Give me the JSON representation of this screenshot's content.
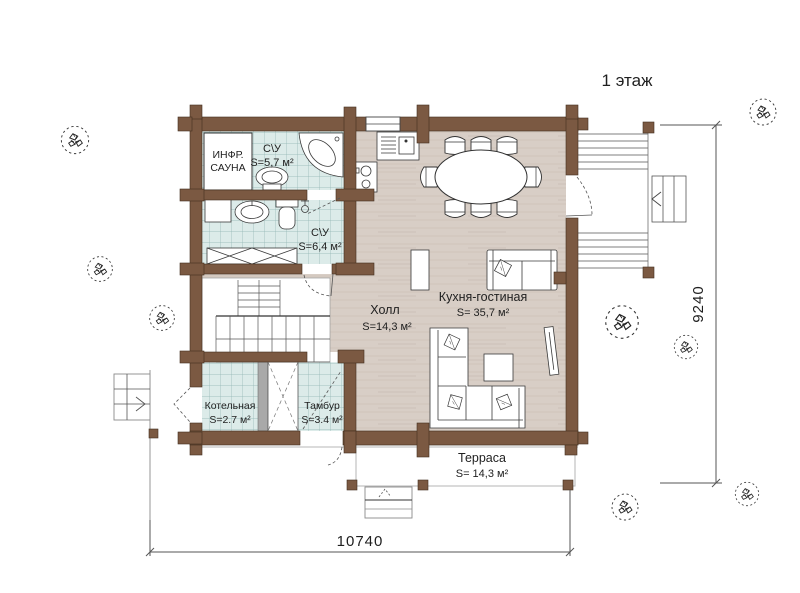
{
  "title": "1 этаж",
  "rooms": {
    "sauna": {
      "line1": "ИНФР.",
      "line2": "САУНА"
    },
    "wc1": {
      "label": "С\\У",
      "area": "S=5,7 м²"
    },
    "wc2": {
      "label": "С\\У",
      "area": "S=6,4 м²"
    },
    "hall": {
      "label": "Холл",
      "area": "S=14,3 м²"
    },
    "kitchen": {
      "label": "Кухня-гостиная",
      "area": "S= 35,7 м²"
    },
    "boiler": {
      "label": "Котельная",
      "area": "S=2.7 м²"
    },
    "tambour": {
      "label": "Тамбур",
      "area": "S=3.4 м²"
    },
    "terrace": {
      "label": "Терраса",
      "area": "S= 14,3 м²"
    }
  },
  "dimensions": {
    "width": "10740",
    "height": "9240"
  },
  "colors": {
    "wall": "#7b5942",
    "tile": "#dcebe9",
    "wood": "#d8cec6",
    "shaft_wall": "#a9a9a9",
    "ink": "#1f1f1f"
  }
}
